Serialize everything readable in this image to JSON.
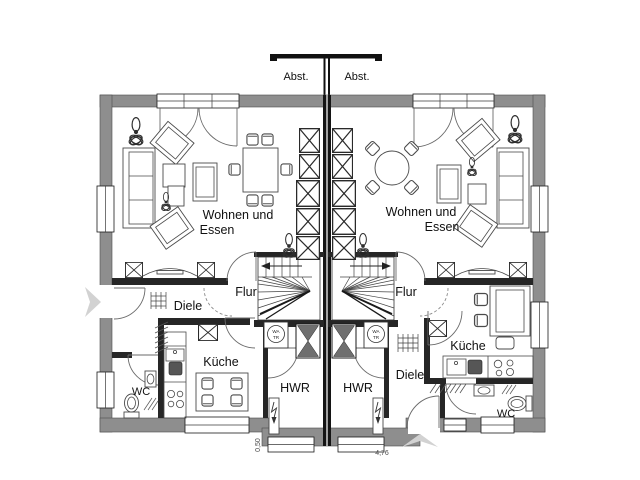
{
  "plan": {
    "colors": {
      "wall_gray": "#8e8e8e",
      "party_wall": "#141414",
      "chimney_gray": "#6f6f6f",
      "arrow_gray": "#d2d2d2"
    },
    "annex": {
      "left_label": "Abst.",
      "right_label": "Abst."
    },
    "unit_left": {
      "living1": "Wohnen und",
      "living2": "Essen",
      "flur": "Flur",
      "diele": "Diele",
      "kueche": "Küche",
      "wc": "WC",
      "hwr": "HWR",
      "washer1": "WA",
      "washer2": "TR"
    },
    "unit_right": {
      "living1": "Wohnen und",
      "living2": "Essen",
      "flur": "Flur",
      "diele": "Diele",
      "kueche": "Küche",
      "wc": "WC",
      "hwr": "HWR",
      "washer1": "WA",
      "washer2": "TR"
    },
    "dimensions": {
      "side": "0,50",
      "width": "4,76"
    }
  }
}
